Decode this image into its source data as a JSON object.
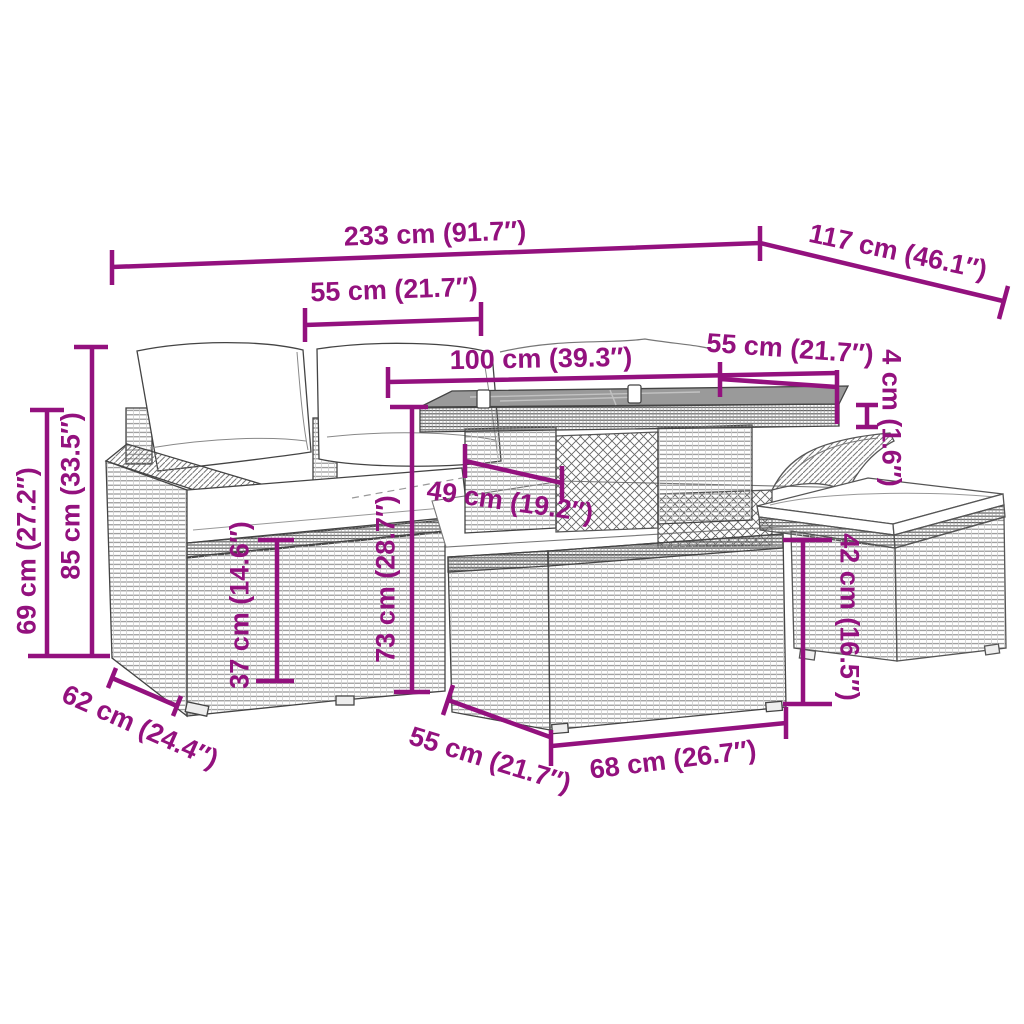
{
  "diagram": {
    "kind": "product-dimension-diagram",
    "subject": "rattan garden furniture set with table and ottoman"
  },
  "colors": {
    "dimension_accent": "#93117E",
    "line_art": "#444444",
    "glass_top": "#9a9a9a",
    "background": "#ffffff"
  },
  "dims": {
    "overall_width": "233 cm (91.7″)",
    "overall_depth": "117 cm (46.1″)",
    "left_seat_width": "55 cm (21.7″)",
    "table_length": "100 cm (39.3″)",
    "right_seat_width": "55 cm (21.7″)",
    "tabletop_thickness": "4 cm (1.6″)",
    "backrest_height": "85 cm (33.5″)",
    "armrest_height": "69 cm (27.2″)",
    "seat_depth": "62 cm (24.4″)",
    "seat_height": "37 cm (14.6″)",
    "table_height": "73 cm (28.7″)",
    "under_table_clearance": "49 cm (19.2″)",
    "ottoman_height": "42 cm (16.5″)",
    "section_depth": "55 cm (21.7″)",
    "section_width": "68 cm (26.7″)"
  }
}
